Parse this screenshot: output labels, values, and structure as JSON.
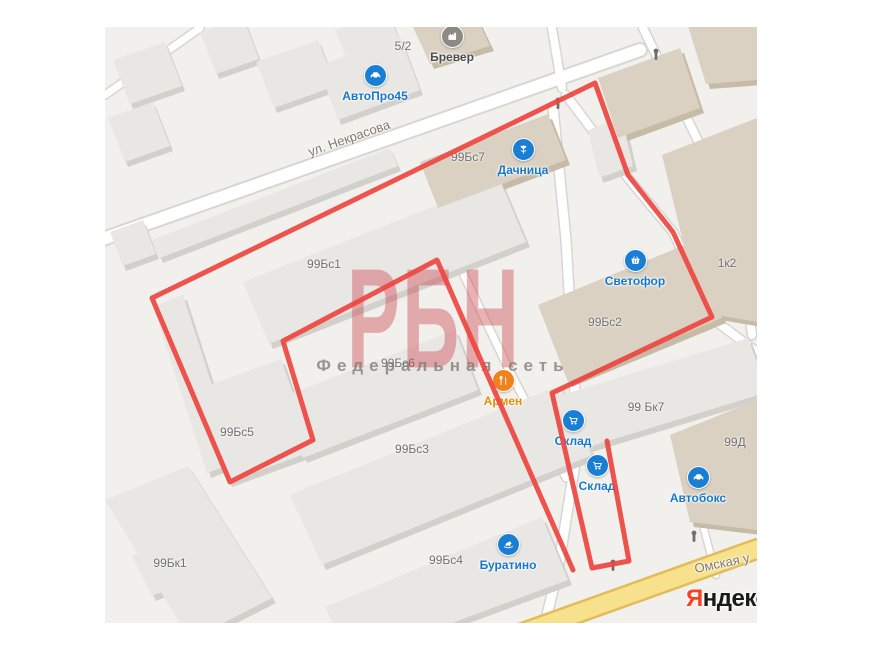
{
  "map": {
    "watermark": {
      "title": "РБН",
      "subtitle": "Федеральная сеть"
    },
    "logo": {
      "first": "Я",
      "rest": "ндекс"
    },
    "streets": [
      {
        "name": "ул. Некрасова"
      },
      {
        "name": "Омская у"
      }
    ],
    "building_labels": [
      {
        "text": "5/2"
      },
      {
        "text": "99Бс7"
      },
      {
        "text": "99Бс1"
      },
      {
        "text": "99Бс2"
      },
      {
        "text": "1к2"
      },
      {
        "text": "99Бс6"
      },
      {
        "text": "99Бс5"
      },
      {
        "text": "99Бс3"
      },
      {
        "text": "99 Бк7"
      },
      {
        "text": "99Д"
      },
      {
        "text": "99Бс4"
      },
      {
        "text": "99Бк1"
      }
    ],
    "pois": [
      {
        "label": "Бревер",
        "icon": "factory-icon",
        "pin_color": "#8d8a86",
        "label_color": "#4c4c4c"
      },
      {
        "label": "АвтоПро45",
        "icon": "car-icon",
        "pin_color": "#1a7fd4",
        "label_color": "#1878c8"
      },
      {
        "label": "Дачница",
        "icon": "flower-icon",
        "pin_color": "#1a7fd4",
        "label_color": "#1878c8"
      },
      {
        "label": "Светофор",
        "icon": "basket-icon",
        "pin_color": "#1a7fd4",
        "label_color": "#1878c8"
      },
      {
        "label": "Армен",
        "icon": "restaurant-icon",
        "pin_color": "#f0821e",
        "label_color": "#ec8a00"
      },
      {
        "label": "Склад",
        "icon": "cart-icon",
        "pin_color": "#1a7fd4",
        "label_color": "#1878c8"
      },
      {
        "label": "Склад",
        "icon": "cart-icon",
        "pin_color": "#1a7fd4",
        "label_color": "#1878c8"
      },
      {
        "label": "Автобокс",
        "icon": "car-icon",
        "pin_color": "#1a7fd4",
        "label_color": "#1878c8"
      },
      {
        "label": "Буратино",
        "icon": "rocking-horse-icon",
        "pin_color": "#1a7fd4",
        "label_color": "#1878c8"
      }
    ],
    "colors": {
      "boundary_red": "#ee4540",
      "map_background": "#f1f0ed",
      "road_fill": "#ffffff",
      "road_casing": "#d8d6d2",
      "main_road_fill": "#f7e18c",
      "main_road_casing": "#e3bc59",
      "building_gray": "#e8e7e4",
      "building_tan": "#dbd1c2",
      "poi_blue": "#1a7fd4",
      "poi_orange": "#f0821e",
      "logo_red": "#fc3f1d"
    }
  }
}
